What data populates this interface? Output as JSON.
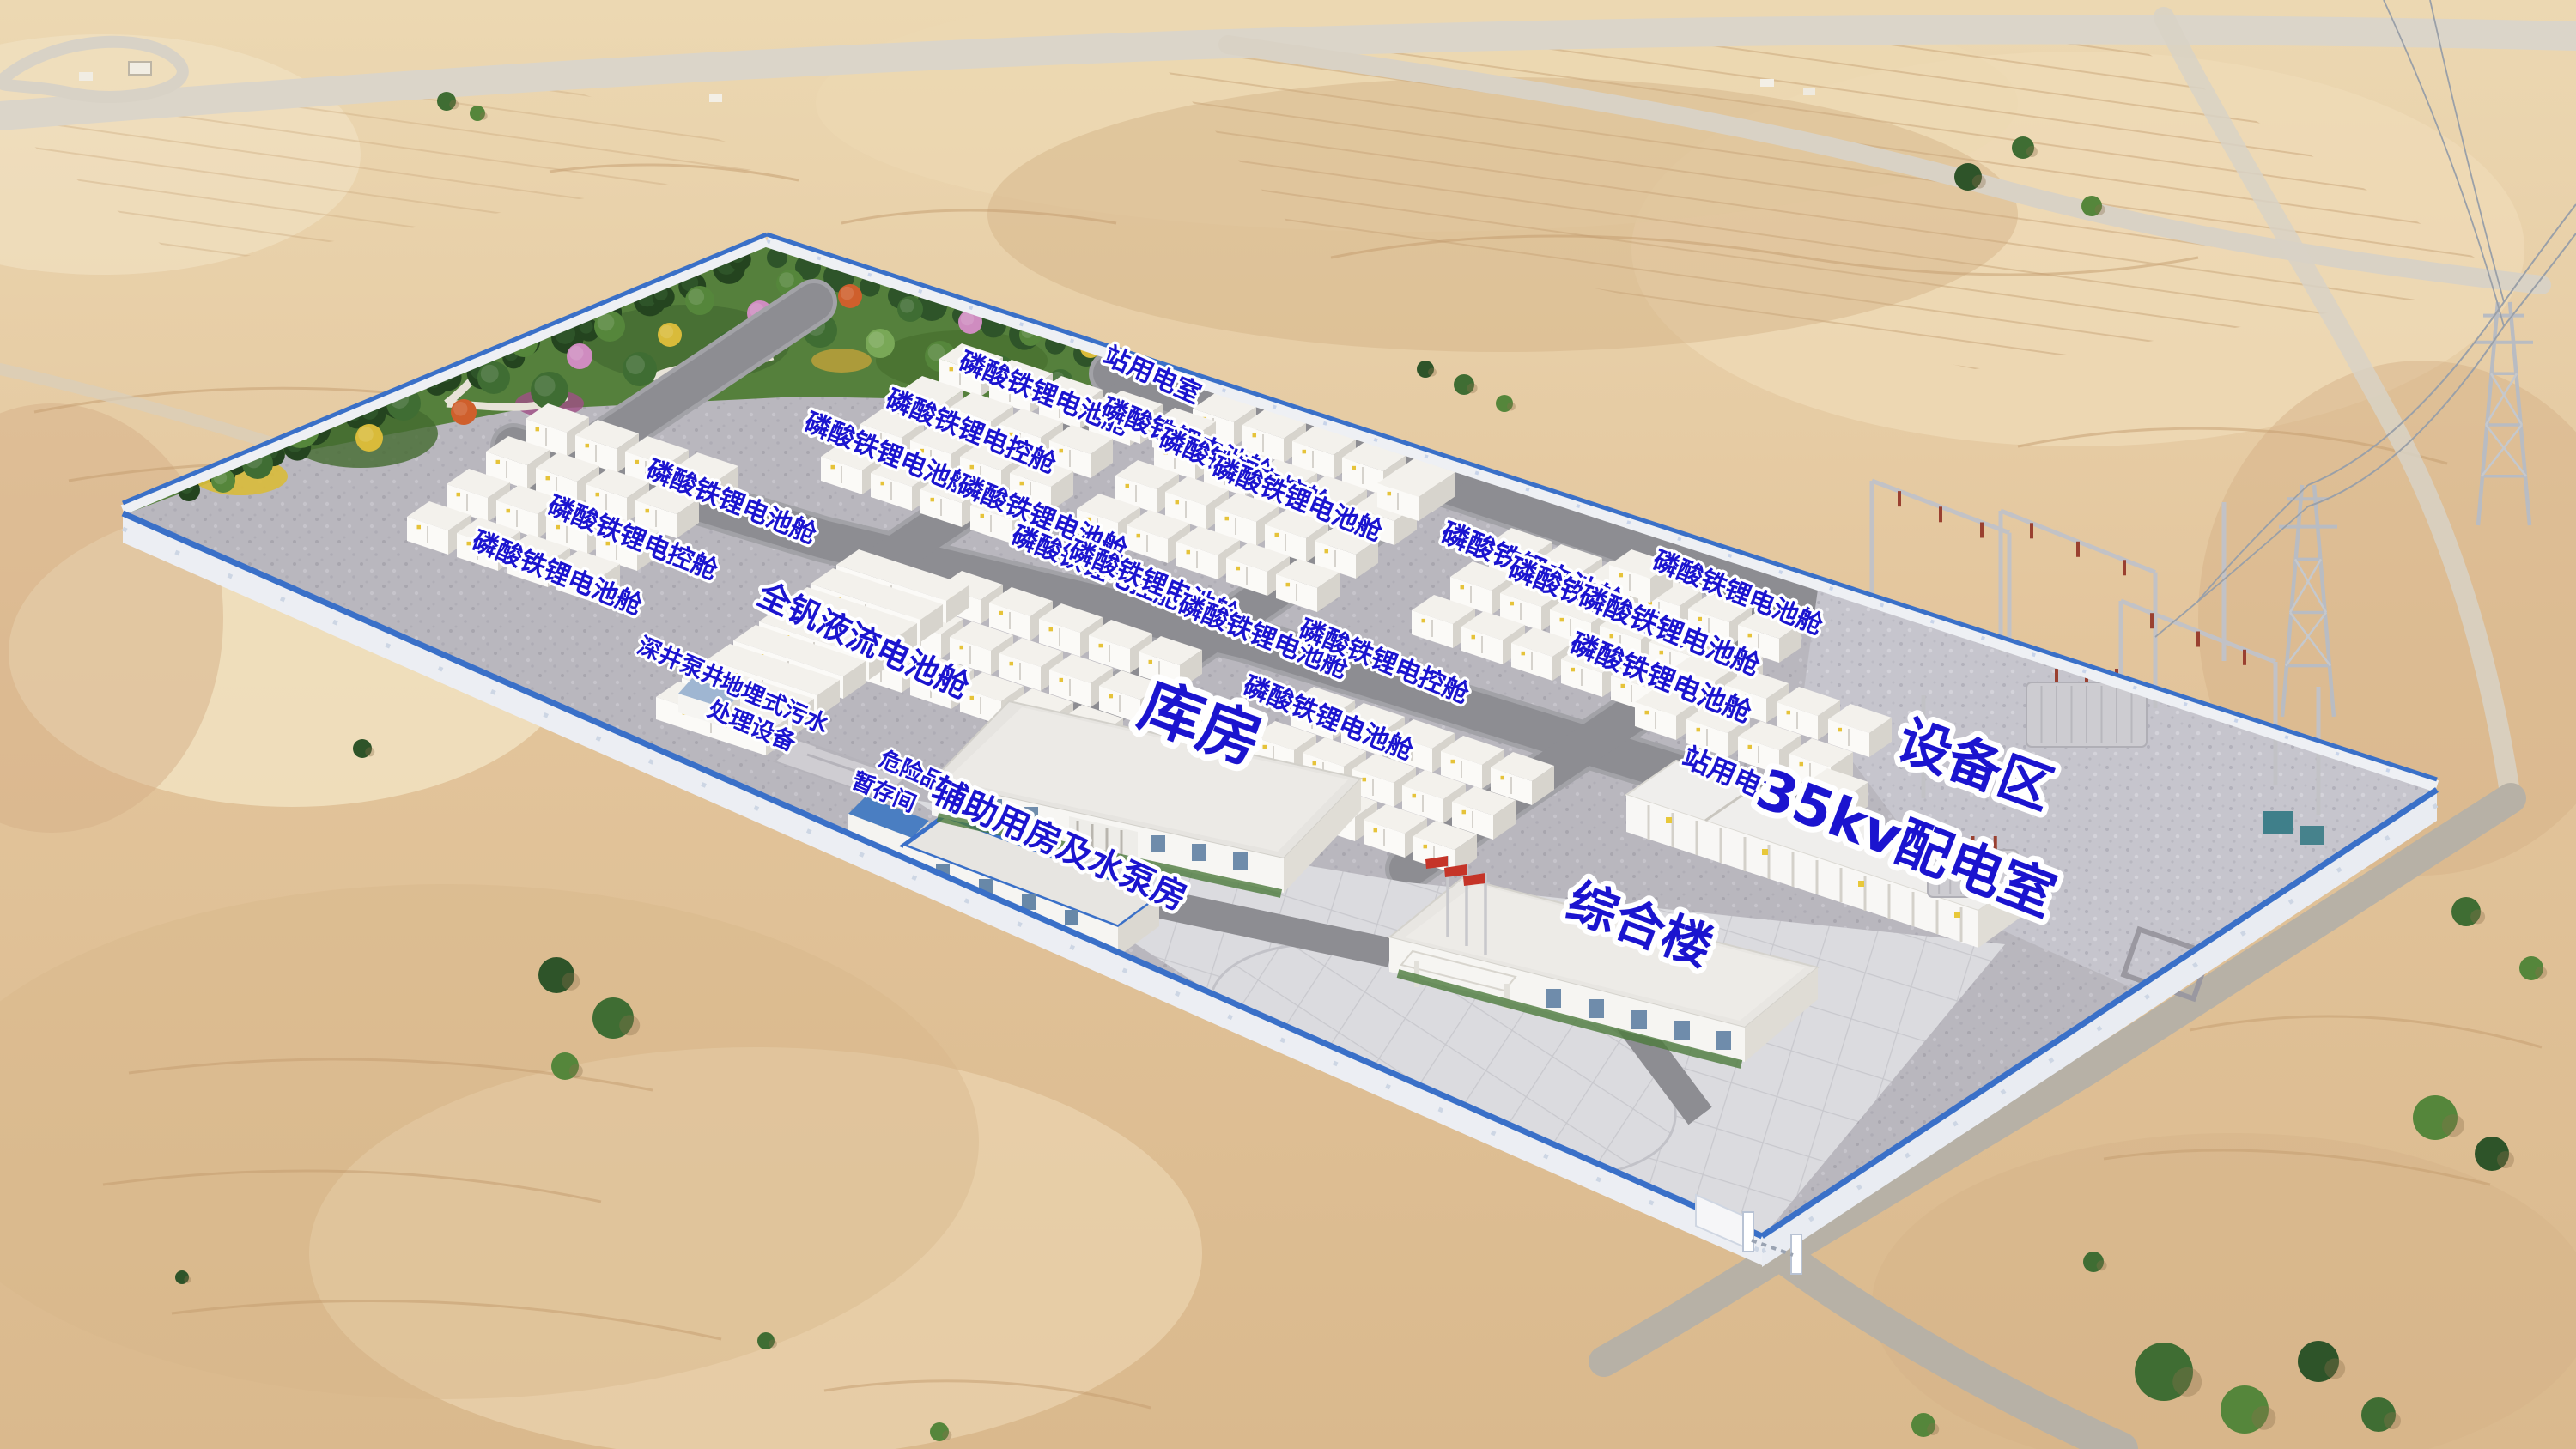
{
  "colors": {
    "label_text_blue": "#1b14cf",
    "wall_trim_blue": "#3a70c8",
    "flag_red": "#c53428",
    "sand": "#e3c59c",
    "concrete_yard": "#b9b7be"
  },
  "labels": [
    {
      "name": "battery-cabin",
      "text": "磷酸铁锂电池舱"
    },
    {
      "name": "control-cabin",
      "text": "磷酸铁锂电控舱"
    },
    {
      "name": "battery-cabin",
      "text": "磷酸铁锂电池舱"
    },
    {
      "name": "battery-cabin",
      "text": "磷酸铁锂电池舱"
    },
    {
      "name": "control-cabin",
      "text": "磷酸铁锂电控舱"
    },
    {
      "name": "battery-cabin",
      "text": "磷酸铁锂电池舱"
    },
    {
      "name": "station-power-room",
      "text": "站用电室"
    },
    {
      "name": "battery-cabin",
      "text": "磷酸铁锂电池舱"
    },
    {
      "name": "control-cabin",
      "text": "磷酸铁锂电控舱"
    },
    {
      "name": "battery-cabin",
      "text": "磷酸铁锂电池舱"
    },
    {
      "name": "battery-cabin",
      "text": "磷酸铁锂电池舱"
    },
    {
      "name": "control-cabin",
      "text": "磷酸铁锂电控舱"
    },
    {
      "name": "battery-cabin",
      "text": "磷酸铁锂电池舱"
    },
    {
      "name": "battery-cabin",
      "text": "磷酸铁锂电池舱"
    },
    {
      "name": "control-cabin",
      "text": "磷酸铁锂电控舱"
    },
    {
      "name": "battery-cabin",
      "text": "磷酸铁锂电池舱"
    },
    {
      "name": "battery-cabin",
      "text": "磷酸铁锂电池舱"
    },
    {
      "name": "control-cabin",
      "text": "磷酸铁锂电控舱"
    },
    {
      "name": "battery-cabin",
      "text": "磷酸铁锂电池舱"
    },
    {
      "name": "battery-cabin",
      "text": "磷酸铁锂电池舱"
    },
    {
      "name": "battery-cabin",
      "text": "磷酸铁锂电池舱"
    },
    {
      "name": "vanadium-flow-cabin",
      "text": "全钒液流电池舱"
    },
    {
      "name": "deep-well-pump",
      "text": "深井泵井"
    },
    {
      "name": "sewage-treatment-line1",
      "text": "地埋式污水"
    },
    {
      "name": "sewage-treatment-line2",
      "text": "处理设备"
    },
    {
      "name": "hazmat-storage-line1",
      "text": "危险品"
    },
    {
      "name": "hazmat-storage-line2",
      "text": "暂存间"
    },
    {
      "name": "auxiliary-pump-house",
      "text": "辅助用房及水泵房"
    },
    {
      "name": "warehouse",
      "text": "库房"
    },
    {
      "name": "office-building",
      "text": "综合楼"
    },
    {
      "name": "station-power-room",
      "text": "站用电室"
    },
    {
      "name": "distribution-room-35kv",
      "text": "35kv配电室"
    },
    {
      "name": "equipment-area",
      "text": "设备区"
    }
  ]
}
